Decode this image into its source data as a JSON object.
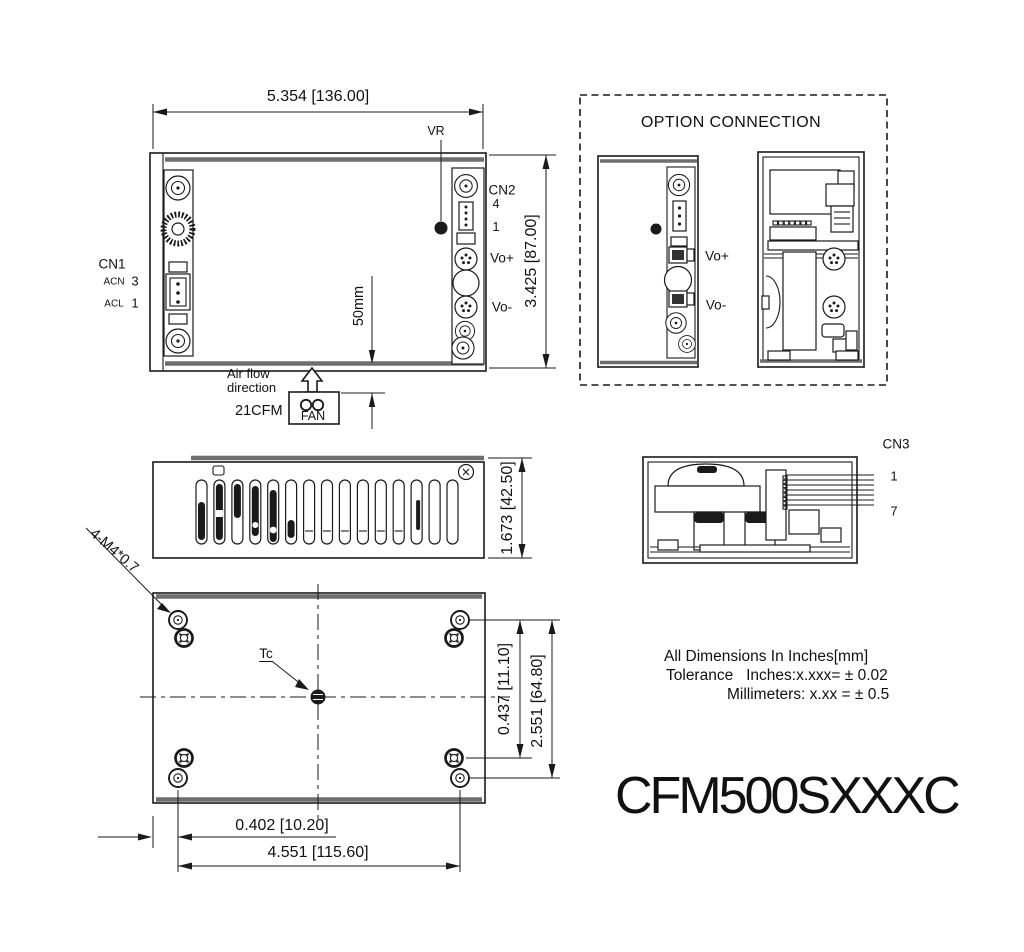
{
  "top_view": {
    "width_dim": "5.354 [136.00]",
    "height_dim": "3.425 [87.00]",
    "vr": "VR",
    "cn2_label": "CN2",
    "cn2_pin_top": "4",
    "cn2_pin_bottom": "1",
    "vo_plus": "Vo+",
    "vo_minus": "Vo-",
    "cn1_label": "CN1",
    "acn_label": "ACN",
    "acn_pin": "3",
    "acl_label": "ACL",
    "acl_pin": "1",
    "airflow_line1": "Air flow",
    "airflow_line2": "direction",
    "fan_flow": "21CFM",
    "fan_label": "FAN",
    "fan_distance": "50mm"
  },
  "option_connection": {
    "title": "OPTION CONNECTION",
    "vo_plus": "Vo+",
    "vo_minus": "Vo-"
  },
  "side_view": {
    "height_dim": "1.673 [42.50]"
  },
  "cn3_view": {
    "label": "CN3",
    "pin_first": "1",
    "pin_last": "7"
  },
  "bottom_view": {
    "mounting_holes": "4-M4*0.7",
    "thermal_point": "Tc",
    "hole_offset_dim": "0.437 [11.10]",
    "vertical_dim": "2.551 [64.80]",
    "edge_offset_dim": "0.402 [10.20]",
    "horizontal_dim": "4.551 [115.60]"
  },
  "notes": {
    "line1": "All Dimensions In Inches[mm]",
    "line2": "Tolerance   Inches:x.xxx= ± 0.02",
    "line3": "Millimeters: x.xx = ± 0.5"
  },
  "model_number": "CFM500SXXXC",
  "colors": {
    "line": "#1a1a1a",
    "edge": "#6e6e6e",
    "background": "#ffffff"
  }
}
